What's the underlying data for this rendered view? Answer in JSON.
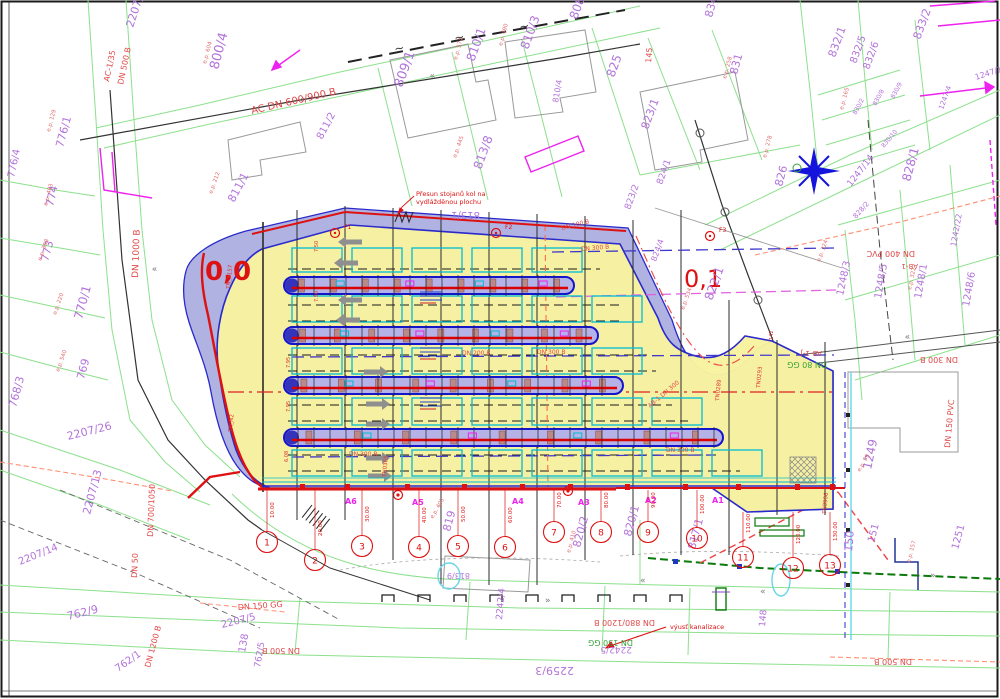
{
  "colors": {
    "parcel_line": "#8ce08c",
    "parcel_text": "#b273da",
    "ep_text": "#e06a6a",
    "pipe_red": "#e04848",
    "pipe_green": "#3aa03a",
    "site_yellow": "#f8f3a0",
    "band_lavender": "#a9abdf",
    "band_blue": "#2a2acc",
    "red": "#dd1111",
    "magenta": "#ee22ee",
    "cyan": "#00bcd4",
    "arrow_gray": "#8f8f8f",
    "star_blue": "#1414dd",
    "dark_green": "#0a7a0a"
  },
  "annotations": {
    "bike_racks_line1": "Přesun stojanů kol na",
    "bike_racks_line2": "vydlážděnou plochu",
    "sewer_outfall": "výusť kanalizace",
    "km_left": "0,0",
    "km_right": "0,1"
  },
  "platform_markers": [
    {
      "t": "F1",
      "x": 344,
      "y": 229
    },
    {
      "t": "F2",
      "x": 505,
      "y": 229
    },
    {
      "t": "F3",
      "x": 719,
      "y": 232
    }
  ],
  "bus_stops": [
    {
      "t": "A6",
      "x": 345,
      "y": 504
    },
    {
      "t": "A5",
      "x": 412,
      "y": 505
    },
    {
      "t": "A4",
      "x": 512,
      "y": 504
    },
    {
      "t": "A3",
      "x": 578,
      "y": 505
    },
    {
      "t": "A2",
      "x": 645,
      "y": 503
    },
    {
      "t": "A1",
      "x": 712,
      "y": 503
    }
  ],
  "section_circles": [
    {
      "n": "1",
      "st": "10.00",
      "x": 267,
      "y": 542,
      "ly": 490
    },
    {
      "n": "2",
      "st": "20.00",
      "x": 315,
      "y": 560,
      "ly": 490
    },
    {
      "n": "3",
      "st": "30.00",
      "x": 362,
      "y": 546,
      "ly": 490
    },
    {
      "n": "4",
      "st": "40.00",
      "x": 419,
      "y": 547,
      "ly": 490
    },
    {
      "n": "5",
      "st": "50.00",
      "x": 458,
      "y": 546,
      "ly": 490
    },
    {
      "n": "6",
      "st": "60.00",
      "x": 505,
      "y": 547,
      "ly": 490
    },
    {
      "n": "7",
      "st": "70.00",
      "x": 554,
      "y": 532,
      "ly": 490
    },
    {
      "n": "8",
      "st": "80.00",
      "x": 601,
      "y": 532,
      "ly": 490
    },
    {
      "n": "9",
      "st": "90.00",
      "x": 648,
      "y": 532,
      "ly": 490
    },
    {
      "n": "10",
      "st": "100.00",
      "x": 697,
      "y": 538,
      "ly": 490
    },
    {
      "n": "11",
      "st": "110.00",
      "x": 743,
      "y": 557,
      "ly": 512
    },
    {
      "n": "12",
      "st": "120.00",
      "x": 793,
      "y": 568,
      "ly": 512
    },
    {
      "n": "13",
      "st": "130.00",
      "x": 830,
      "y": 565,
      "ly": 512
    }
  ],
  "labels": {
    "parcels": [
      {
        "t": "800/4",
        "x": 218,
        "y": 70,
        "r": -75,
        "s": 13
      },
      {
        "t": "2207/9",
        "x": 133,
        "y": 28,
        "r": -72,
        "s": 11
      },
      {
        "t": "776/1",
        "x": 63,
        "y": 148,
        "r": -75,
        "s": 11
      },
      {
        "t": "776/4",
        "x": 14,
        "y": 178,
        "r": -78,
        "s": 10
      },
      {
        "t": "774",
        "x": 53,
        "y": 207,
        "r": -77,
        "s": 11
      },
      {
        "t": "773",
        "x": 48,
        "y": 262,
        "r": -75,
        "s": 11
      },
      {
        "t": "770/1",
        "x": 82,
        "y": 320,
        "r": -75,
        "s": 12
      },
      {
        "t": "769",
        "x": 84,
        "y": 380,
        "r": -75,
        "s": 11
      },
      {
        "t": "768/3",
        "x": 16,
        "y": 408,
        "r": -75,
        "s": 11
      },
      {
        "t": "2207/26",
        "x": 68,
        "y": 440,
        "r": -14,
        "s": 11
      },
      {
        "t": "2207/13",
        "x": 90,
        "y": 515,
        "r": -75,
        "s": 11
      },
      {
        "t": "2207/14",
        "x": 20,
        "y": 565,
        "r": -22,
        "s": 10
      },
      {
        "t": "762/9",
        "x": 68,
        "y": 620,
        "r": -14,
        "s": 11
      },
      {
        "t": "762/1",
        "x": 118,
        "y": 672,
        "r": -35,
        "s": 10
      },
      {
        "t": "2207/5",
        "x": 222,
        "y": 628,
        "r": -14,
        "s": 10
      },
      {
        "t": "138",
        "x": 245,
        "y": 653,
        "r": -80,
        "s": 10
      },
      {
        "t": "762/5",
        "x": 260,
        "y": 668,
        "r": -80,
        "s": 9
      },
      {
        "t": "2259/3",
        "x": 574,
        "y": 667,
        "r": 180,
        "s": 11
      },
      {
        "t": "2242/5",
        "x": 632,
        "y": 647,
        "r": 180,
        "s": 9
      },
      {
        "t": "2242/4",
        "x": 502,
        "y": 620,
        "r": -85,
        "s": 9
      },
      {
        "t": "811/1",
        "x": 234,
        "y": 203,
        "r": -62,
        "s": 11
      },
      {
        "t": "811/2",
        "x": 322,
        "y": 140,
        "r": -62,
        "s": 10
      },
      {
        "t": "809/1",
        "x": 402,
        "y": 88,
        "r": -70,
        "s": 13
      },
      {
        "t": "810/1",
        "x": 474,
        "y": 62,
        "r": -70,
        "s": 12
      },
      {
        "t": "810/3",
        "x": 528,
        "y": 50,
        "r": -70,
        "s": 12
      },
      {
        "t": "810/4",
        "x": 558,
        "y": 103,
        "r": -80,
        "s": 8
      },
      {
        "t": "808",
        "x": 577,
        "y": 20,
        "r": -70,
        "s": 12
      },
      {
        "t": "813/8",
        "x": 481,
        "y": 170,
        "r": -70,
        "s": 12
      },
      {
        "t": "813/1",
        "x": 480,
        "y": 212,
        "r": 180,
        "s": 10
      },
      {
        "t": "825",
        "x": 614,
        "y": 78,
        "r": -70,
        "s": 12
      },
      {
        "t": "823/1",
        "x": 648,
        "y": 130,
        "r": -70,
        "s": 11
      },
      {
        "t": "823/2",
        "x": 630,
        "y": 210,
        "r": -70,
        "s": 9
      },
      {
        "t": "824/1",
        "x": 662,
        "y": 185,
        "r": -70,
        "s": 9
      },
      {
        "t": "834/1",
        "x": 712,
        "y": 18,
        "r": -75,
        "s": 11
      },
      {
        "t": "831",
        "x": 737,
        "y": 75,
        "r": -75,
        "s": 11
      },
      {
        "t": "832/1",
        "x": 835,
        "y": 58,
        "r": -70,
        "s": 11
      },
      {
        "t": "832/5",
        "x": 856,
        "y": 64,
        "r": -70,
        "s": 10
      },
      {
        "t": "832/6",
        "x": 869,
        "y": 70,
        "r": -70,
        "s": 10
      },
      {
        "t": "833/2",
        "x": 920,
        "y": 40,
        "r": -70,
        "s": 11
      },
      {
        "t": "830/2",
        "x": 856,
        "y": 115,
        "r": -62,
        "s": 6
      },
      {
        "t": "830/8",
        "x": 876,
        "y": 106,
        "r": -62,
        "s": 6
      },
      {
        "t": "830/9",
        "x": 894,
        "y": 99,
        "r": -62,
        "s": 6
      },
      {
        "t": "830/10",
        "x": 884,
        "y": 148,
        "r": -50,
        "s": 6
      },
      {
        "t": "828/1",
        "x": 910,
        "y": 182,
        "r": -75,
        "s": 12
      },
      {
        "t": "828/2",
        "x": 856,
        "y": 219,
        "r": -48,
        "s": 7
      },
      {
        "t": "826",
        "x": 782,
        "y": 187,
        "r": -75,
        "s": 11
      },
      {
        "t": "822/1",
        "x": 712,
        "y": 301,
        "r": -70,
        "s": 12
      },
      {
        "t": "824/4",
        "x": 656,
        "y": 262,
        "r": -70,
        "s": 8
      },
      {
        "t": "1247/14",
        "x": 851,
        "y": 187,
        "r": -52,
        "s": 9
      },
      {
        "t": "1247/17",
        "x": 976,
        "y": 80,
        "r": -18,
        "s": 8
      },
      {
        "t": "1247/4",
        "x": 943,
        "y": 110,
        "r": -70,
        "s": 7
      },
      {
        "t": "1242/22",
        "x": 956,
        "y": 247,
        "r": -80,
        "s": 8
      },
      {
        "t": "1248/3",
        "x": 843,
        "y": 296,
        "r": -78,
        "s": 10
      },
      {
        "t": "1248/5",
        "x": 881,
        "y": 299,
        "r": -80,
        "s": 10
      },
      {
        "t": "1248/1",
        "x": 921,
        "y": 299,
        "r": -80,
        "s": 10
      },
      {
        "t": "1248/6",
        "x": 969,
        "y": 307,
        "r": -80,
        "s": 10
      },
      {
        "t": "1249",
        "x": 871,
        "y": 470,
        "r": -78,
        "s": 12
      },
      {
        "t": "1251",
        "x": 958,
        "y": 550,
        "r": -75,
        "s": 10
      },
      {
        "t": "150",
        "x": 852,
        "y": 552,
        "r": -85,
        "s": 11
      },
      {
        "t": "151",
        "x": 874,
        "y": 543,
        "r": -75,
        "s": 10
      },
      {
        "t": "148",
        "x": 765,
        "y": 627,
        "r": -85,
        "s": 9
      },
      {
        "t": "820/2",
        "x": 580,
        "y": 548,
        "r": -75,
        "s": 11
      },
      {
        "t": "820/1",
        "x": 631,
        "y": 537,
        "r": -75,
        "s": 11
      },
      {
        "t": "819",
        "x": 450,
        "y": 532,
        "r": -75,
        "s": 11
      },
      {
        "t": "817/1",
        "x": 695,
        "y": 550,
        "r": -75,
        "s": 11
      },
      {
        "t": "813/9",
        "x": 470,
        "y": 573,
        "r": 180,
        "s": 8
      }
    ],
    "ep": [
      {
        "t": "e.p. 604",
        "x": 206,
        "y": 64,
        "r": -75
      },
      {
        "t": "e.p. 129",
        "x": 50,
        "y": 132,
        "r": -75
      },
      {
        "t": "e.p. 483",
        "x": 47,
        "y": 206,
        "r": -75
      },
      {
        "t": "e.p. 212",
        "x": 212,
        "y": 194,
        "r": -70
      },
      {
        "t": "e.p. 398",
        "x": 41,
        "y": 261,
        "r": -70
      },
      {
        "t": "e.p. 220",
        "x": 56,
        "y": 315,
        "r": -70
      },
      {
        "t": "e.p. 540",
        "x": 59,
        "y": 372,
        "r": -70
      },
      {
        "t": "e.p. 574",
        "x": 457,
        "y": 60,
        "r": -75
      },
      {
        "t": "e.p. 490",
        "x": 502,
        "y": 46,
        "r": -75
      },
      {
        "t": "e.p. 445",
        "x": 456,
        "y": 158,
        "r": -70
      },
      {
        "t": "e.p. 258",
        "x": 726,
        "y": 79,
        "r": -75
      },
      {
        "t": "e.p. 165",
        "x": 843,
        "y": 110,
        "r": -75
      },
      {
        "t": "e.p. 278",
        "x": 766,
        "y": 158,
        "r": -75
      },
      {
        "t": "e.p. 534",
        "x": 684,
        "y": 310,
        "r": -70
      },
      {
        "t": "e.p. 324",
        "x": 820,
        "y": 262,
        "r": -70
      },
      {
        "t": "e.p. 322",
        "x": 911,
        "y": 290,
        "r": -78
      },
      {
        "t": "e.p. 403",
        "x": 433,
        "y": 519,
        "r": -60
      },
      {
        "t": "e.p. 410",
        "x": 570,
        "y": 553,
        "r": -75
      },
      {
        "t": "e.p. 59",
        "x": 860,
        "y": 472,
        "r": -60
      },
      {
        "t": "e.p. 157",
        "x": 910,
        "y": 563,
        "r": -75
      }
    ],
    "pipes": [
      {
        "t": "AC-1/35",
        "x": 109,
        "y": 82,
        "r": -78,
        "s": 8
      },
      {
        "t": "DN 500 B",
        "x": 123,
        "y": 85,
        "r": -78,
        "s": 8
      },
      {
        "t": "AC DN 600/900 B",
        "x": 252,
        "y": 114,
        "r": -13,
        "s": 10
      },
      {
        "t": "DN 1000 B",
        "x": 138,
        "y": 278,
        "r": -88,
        "s": 9
      },
      {
        "t": "DN 700/1050",
        "x": 153,
        "y": 537,
        "r": -88,
        "s": 8
      },
      {
        "t": "DN 50",
        "x": 137,
        "y": 578,
        "r": -88,
        "s": 8
      },
      {
        "t": "DN 1200 B",
        "x": 150,
        "y": 668,
        "r": -75,
        "s": 8
      },
      {
        "t": "DN 150 GG",
        "x": 238,
        "y": 610,
        "r": -4,
        "s": 8
      },
      {
        "t": "DN 500 B",
        "x": 300,
        "y": 648,
        "r": 180,
        "s": 8
      },
      {
        "t": "DN 880/1200 B",
        "x": 655,
        "y": 620,
        "r": 180,
        "s": 8
      },
      {
        "t": "DN 150 GG",
        "x": 633,
        "y": 640,
        "r": 180,
        "s": 8,
        "c": "pipe_green"
      },
      {
        "t": "DN 500 B",
        "x": 912,
        "y": 659,
        "r": 180,
        "s": 8
      },
      {
        "t": "DN 400 PVC",
        "x": 915,
        "y": 251,
        "r": 180,
        "s": 8
      },
      {
        "t": "AB-1",
        "x": 918,
        "y": 264,
        "r": 180,
        "s": 7
      },
      {
        "t": "DN 150 PVC",
        "x": 950,
        "y": 448,
        "r": -85,
        "s": 8
      },
      {
        "t": "DN 80 GG",
        "x": 827,
        "y": 362,
        "r": 180,
        "s": 8,
        "c": "pipe_green"
      },
      {
        "t": "AB-1-J",
        "x": 822,
        "y": 351,
        "r": 180,
        "s": 7
      },
      {
        "t": "DN 300 B",
        "x": 958,
        "y": 357,
        "r": 180,
        "s": 8
      },
      {
        "t": "DN 100 B",
        "x": 562,
        "y": 230,
        "r": -14,
        "s": 6
      },
      {
        "t": "DN 300 B",
        "x": 581,
        "y": 251,
        "r": -5,
        "s": 6
      },
      {
        "t": "DN 200 B",
        "x": 462,
        "y": 355,
        "r": 0,
        "s": 6
      },
      {
        "t": "DN 300 B",
        "x": 537,
        "y": 354,
        "r": 0,
        "s": 6
      },
      {
        "t": "DN 300 B",
        "x": 349,
        "y": 456,
        "r": 0,
        "s": 6
      },
      {
        "t": "DN 300 B",
        "x": 666,
        "y": 452,
        "r": 0,
        "s": 6
      },
      {
        "t": "AB-1 DN 300",
        "x": 650,
        "y": 408,
        "r": -40,
        "s": 6
      },
      {
        "t": "145",
        "x": 651,
        "y": 63,
        "r": -85,
        "s": 8
      }
    ],
    "tn": [
      {
        "t": "TN_3157",
        "x": 230,
        "y": 289,
        "r": -85
      },
      {
        "t": "TN_N2",
        "x": 232,
        "y": 432,
        "r": -85
      },
      {
        "t": "TN0293",
        "x": 760,
        "y": 388,
        "r": -85
      },
      {
        "t": "TN0289",
        "x": 719,
        "y": 401,
        "r": -85
      },
      {
        "t": "TN0365",
        "x": 386,
        "y": 477,
        "r": -85
      },
      {
        "t": "TN0906",
        "x": 826,
        "y": 514,
        "r": -85
      }
    ],
    "dims": [
      {
        "t": "7.50",
        "x": 318,
        "y": 252
      },
      {
        "t": "7.50",
        "x": 318,
        "y": 302
      },
      {
        "t": "7.95",
        "x": 290,
        "y": 368
      },
      {
        "t": "7.95",
        "x": 290,
        "y": 412
      },
      {
        "t": "6.08",
        "x": 288,
        "y": 462
      },
      {
        "t": "142",
        "x": 773,
        "y": 340
      }
    ]
  }
}
